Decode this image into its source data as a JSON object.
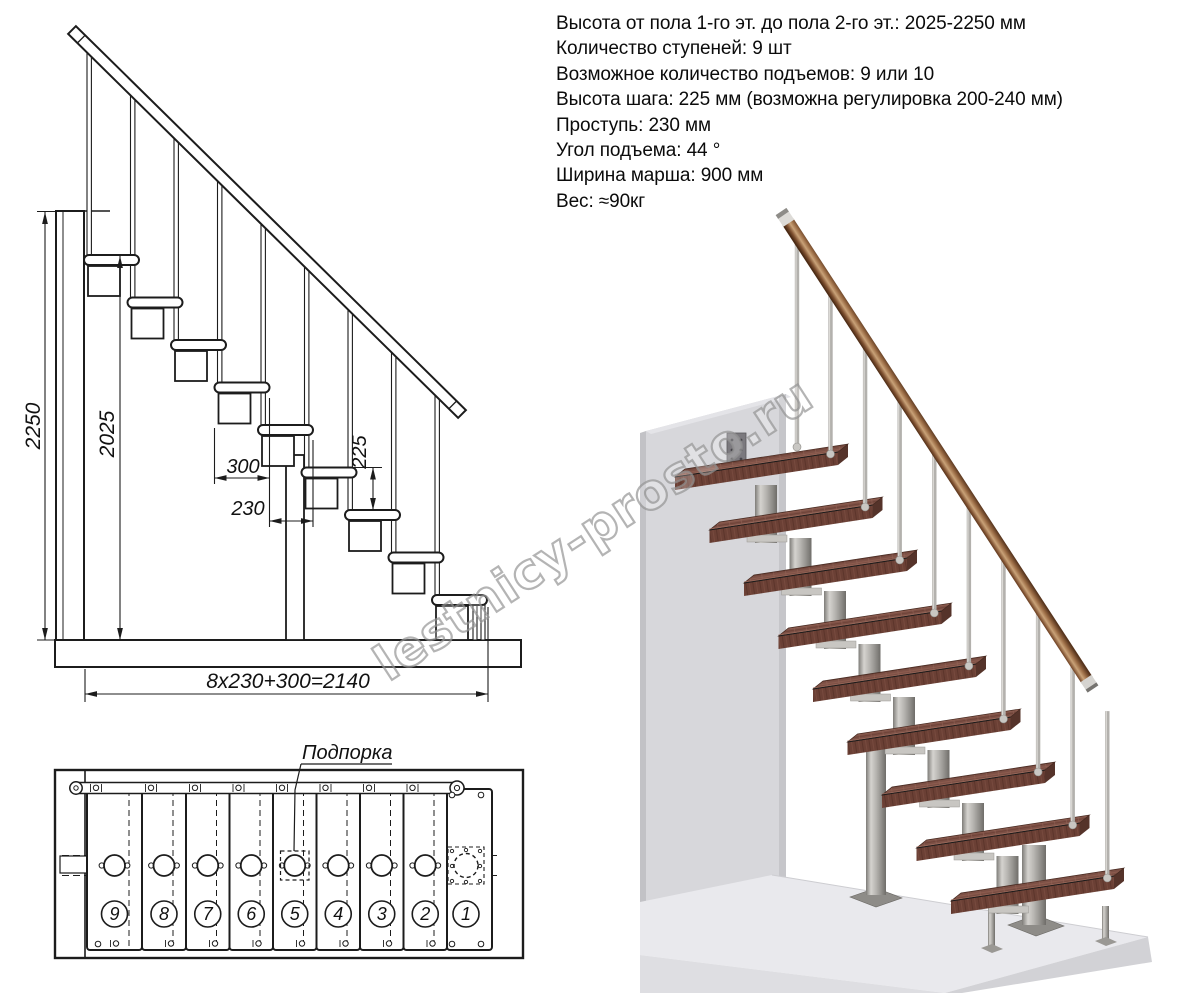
{
  "specs": {
    "lines": [
      "Высота от пола 1-го эт. до пола 2-го эт.: 2025-2250 мм",
      "Количество ступеней: 9 шт",
      "Возможное количество подъемов: 9 или 10",
      "Высота шага: 225 мм (возможна регулировка 200-240 мм)",
      "Проступь: 230 мм",
      "Угол подъема: 44 °",
      "Ширина марша: 900 мм",
      "Вес: ≈90кг"
    ]
  },
  "side_view": {
    "dim_total_height": "2250",
    "dim_stair_height": "2025",
    "dim_tread_depth": "300",
    "dim_step_run": "230",
    "dim_riser_height": "225",
    "dim_total_run": "8x230+300=2140"
  },
  "plan_view": {
    "support_label": "Подпорка",
    "step_numbers": [
      "9",
      "8",
      "7",
      "6",
      "5",
      "4",
      "3",
      "2",
      "1"
    ]
  },
  "watermark": {
    "text": "lestnicy-prosto.ru"
  },
  "colors": {
    "line": "#1c1c1c",
    "wood_tread_top": "#7d5146",
    "wood_tread_front": "#6b4035",
    "wood_tread_side": "#55332a",
    "wood_rail_mid": "#c9a278",
    "metal": "#b3b1ad",
    "wall": "#d7d7db",
    "floor": "#e9e9ed"
  }
}
